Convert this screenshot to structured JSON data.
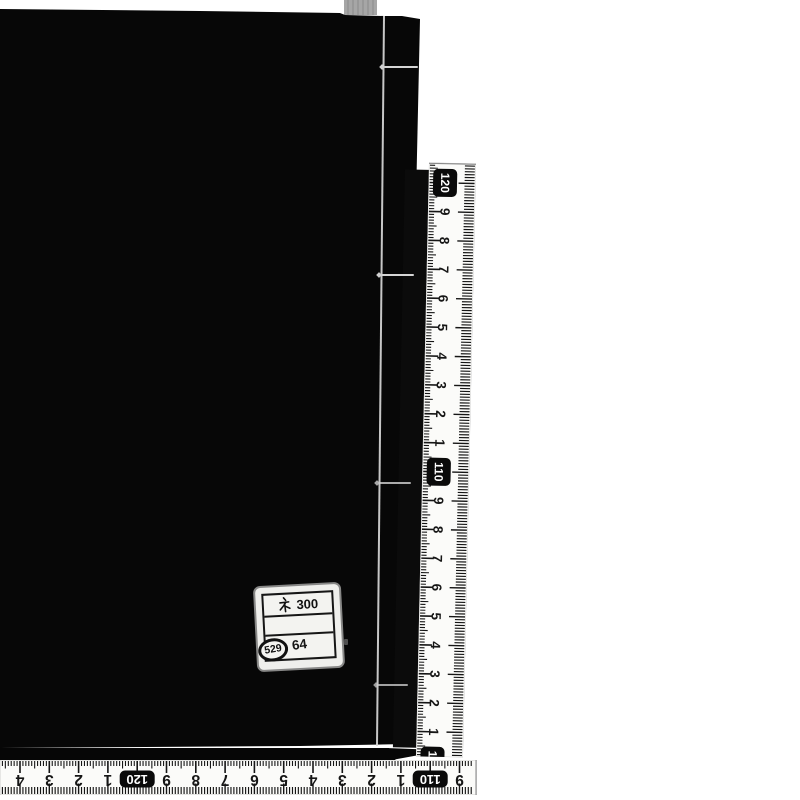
{
  "photo": {
    "background": "#ffffff",
    "book_color": "#070707",
    "tab_color": "#a6a6a6",
    "ruler_face": "#fbfbf9",
    "tick_color": "#161616",
    "box_color": "#0a0a0a",
    "box_text_color": "#ffffff"
  },
  "sticker": {
    "line1": "ネ 300",
    "line1_symbol": "ネ",
    "line1_number": "300",
    "line2": "",
    "circled_number": "529",
    "right_number": "64"
  },
  "vertical_ruler": {
    "orientation": "vertical",
    "numbers": [
      {
        "text": "120",
        "boxed": true
      },
      {
        "text": "9",
        "boxed": false
      },
      {
        "text": "8",
        "boxed": false
      },
      {
        "text": "7",
        "boxed": false
      },
      {
        "text": "6",
        "boxed": false
      },
      {
        "text": "5",
        "boxed": false
      },
      {
        "text": "4",
        "boxed": false
      },
      {
        "text": "3",
        "boxed": false
      },
      {
        "text": "2",
        "boxed": false
      },
      {
        "text": "1",
        "boxed": false
      },
      {
        "text": "110",
        "boxed": true
      },
      {
        "text": "9",
        "boxed": false
      },
      {
        "text": "8",
        "boxed": false
      },
      {
        "text": "7",
        "boxed": false
      },
      {
        "text": "6",
        "boxed": false
      },
      {
        "text": "5",
        "boxed": false
      },
      {
        "text": "4",
        "boxed": false
      },
      {
        "text": "3",
        "boxed": false
      },
      {
        "text": "2",
        "boxed": false
      },
      {
        "text": "1",
        "boxed": false
      },
      {
        "text": "100",
        "boxed": true
      }
    ]
  },
  "horizontal_ruler": {
    "orientation": "horizontal",
    "upside_down": true,
    "numbers": [
      {
        "text": "4",
        "boxed": false
      },
      {
        "text": "3",
        "boxed": false
      },
      {
        "text": "2",
        "boxed": false
      },
      {
        "text": "1",
        "boxed": false
      },
      {
        "text": "120",
        "boxed": true
      },
      {
        "text": "9",
        "boxed": false
      },
      {
        "text": "8",
        "boxed": false
      },
      {
        "text": "7",
        "boxed": false
      },
      {
        "text": "6",
        "boxed": false
      },
      {
        "text": "5",
        "boxed": false
      },
      {
        "text": "4",
        "boxed": false
      },
      {
        "text": "3",
        "boxed": false
      },
      {
        "text": "2",
        "boxed": false
      },
      {
        "text": "1",
        "boxed": false
      },
      {
        "text": "110",
        "boxed": true
      },
      {
        "text": "9",
        "boxed": false
      }
    ]
  }
}
